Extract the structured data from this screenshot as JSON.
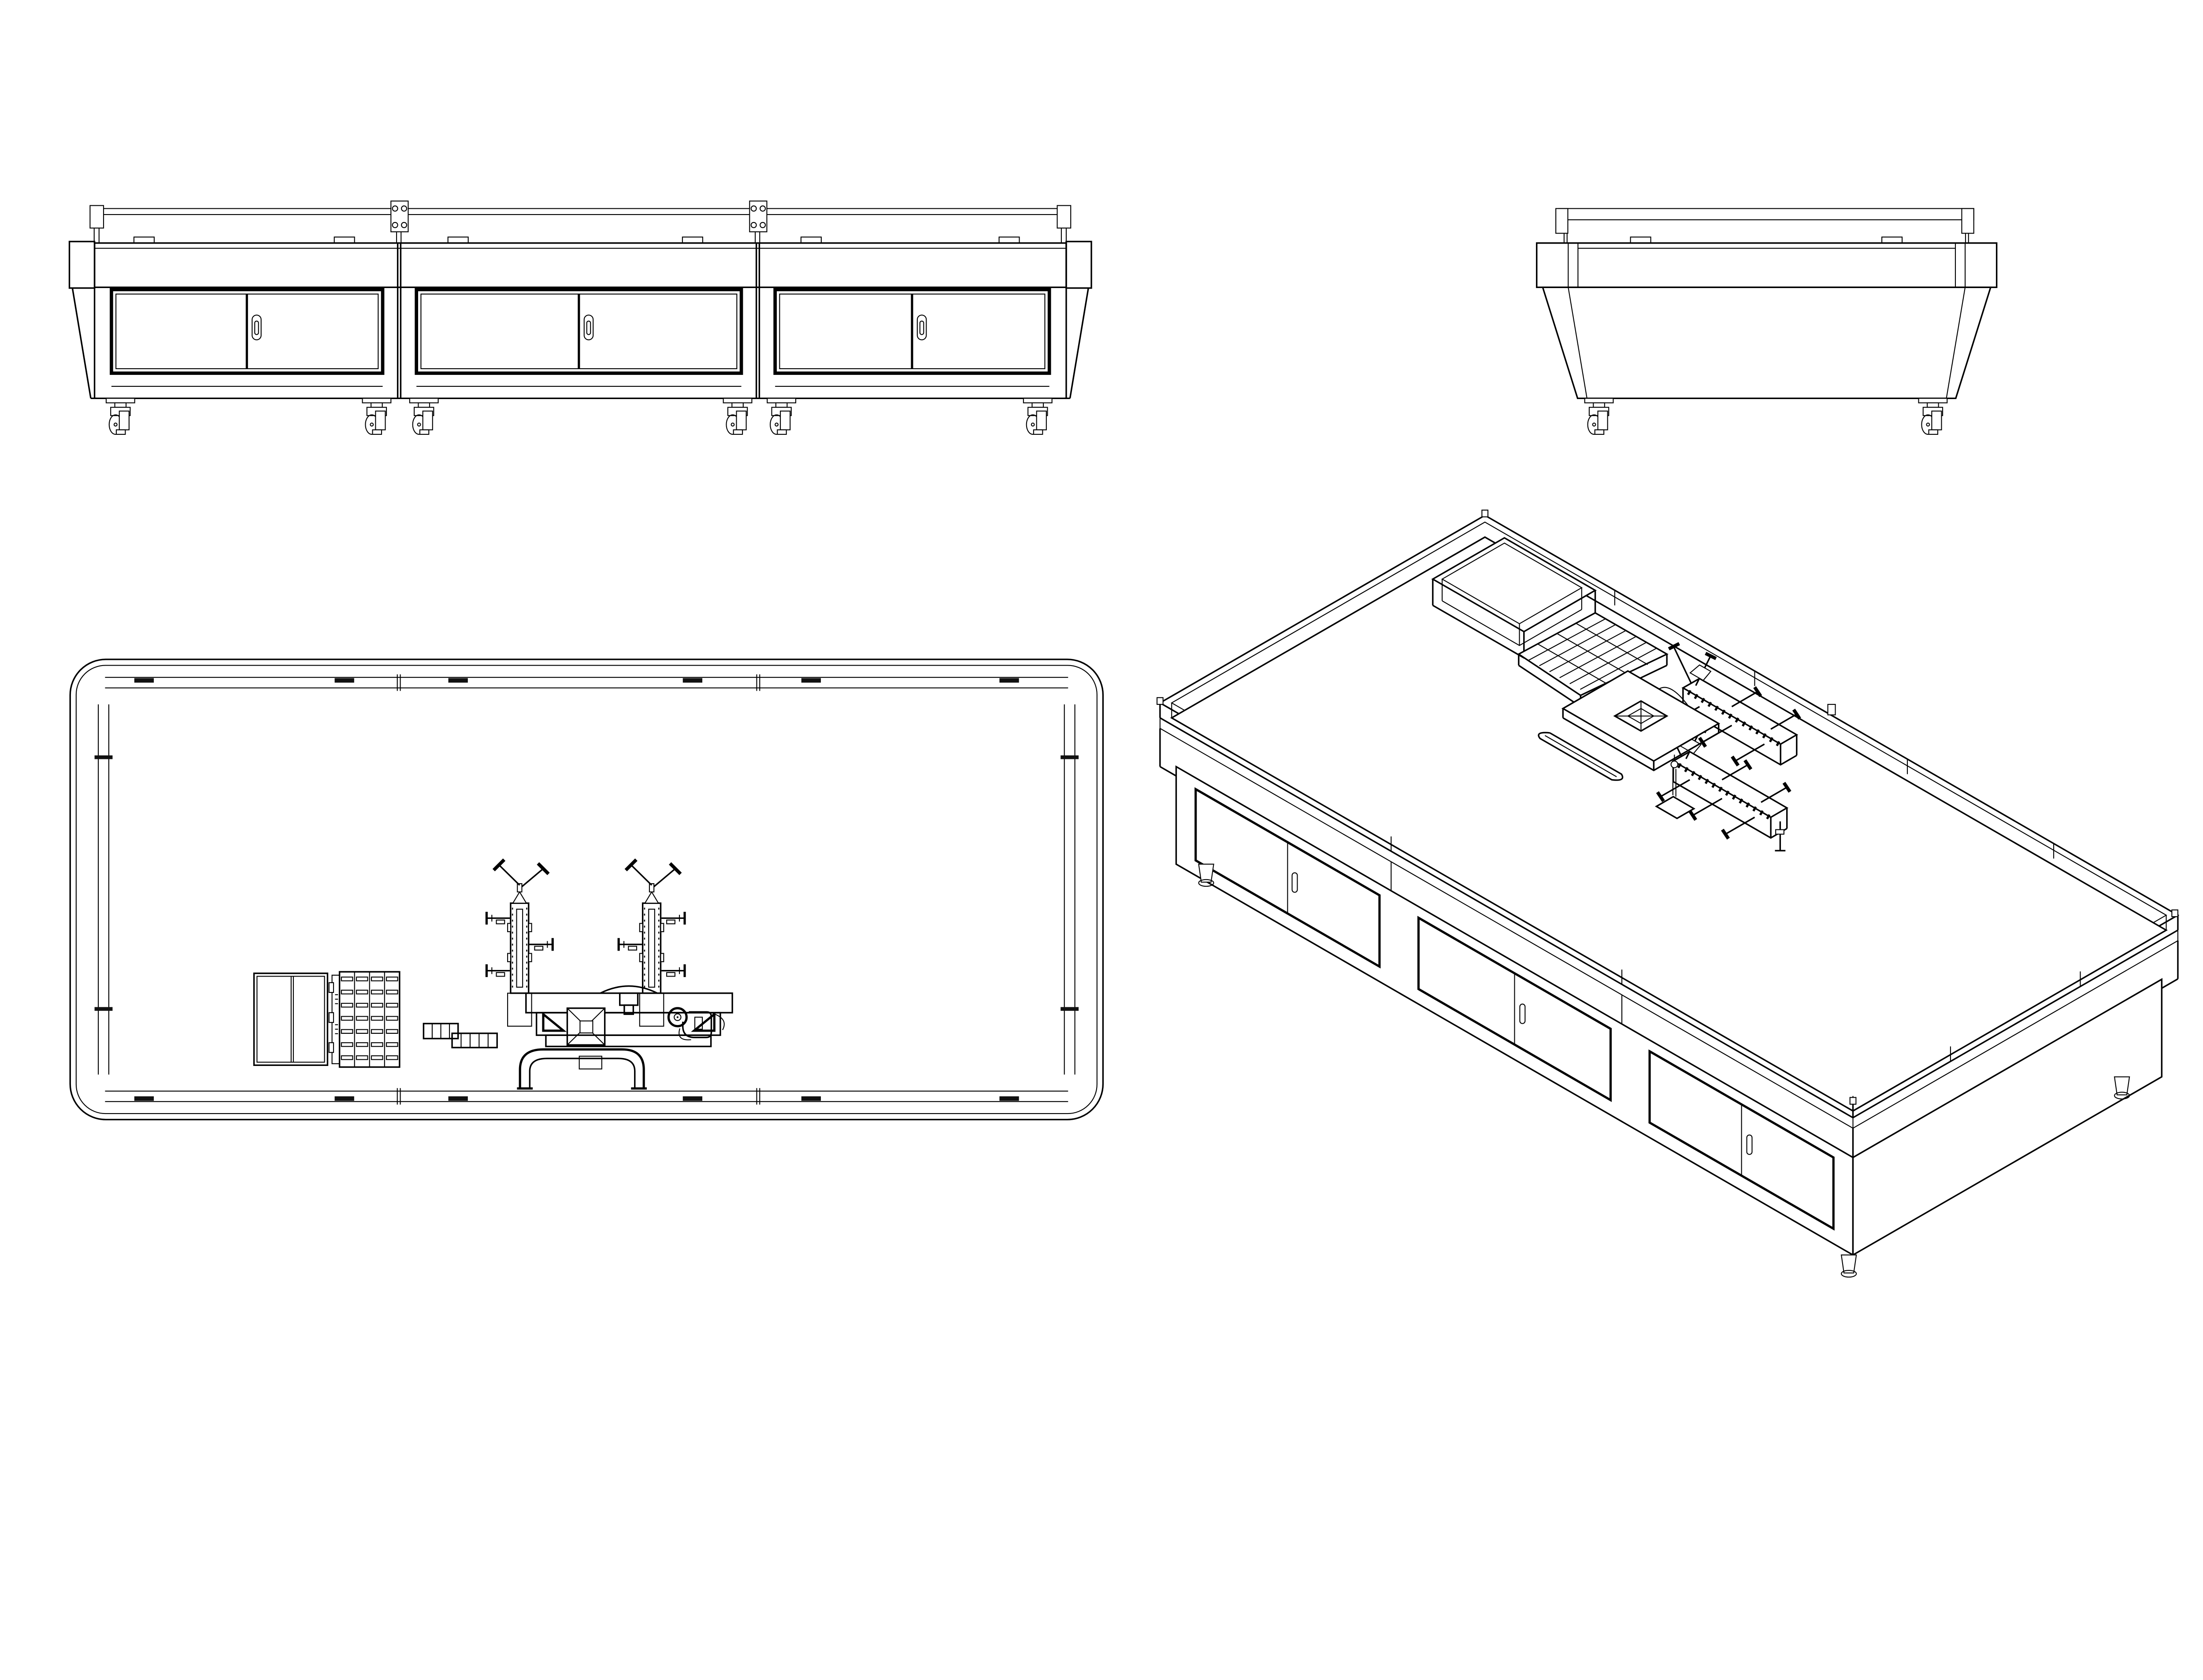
{
  "page": {
    "background": "#ffffff",
    "line_color": "#000000",
    "accent_fill": "#111111",
    "content": "monochrome multi-view CAD line drawing of a mobile cabinet workbench"
  },
  "drawing": {
    "kind": "technical orthographic and isometric views",
    "views": [
      {
        "id": "front-elevation",
        "label": "front elevation view",
        "position": "top-left",
        "cabinet_modules": 3,
        "sliding_doors_per_module": 2,
        "oval_door_handles": 3,
        "casters": 6,
        "top_rail_clips": 6,
        "glass_joint_plates": 2,
        "corner_posts": 2,
        "tapered_end_panels": 2
      },
      {
        "id": "end-elevation",
        "label": "end elevation view",
        "position": "top-right",
        "casters": 2,
        "top_rail_clips": 2,
        "lid_corner_tabs": 2,
        "tapered_body": true
      },
      {
        "id": "plan",
        "label": "top plan view",
        "position": "bottom-left",
        "rounded_corner_top": true,
        "perimeter_rail_clips": 12,
        "rail_joint_ticks": 4,
        "tabletop_items": [
          "dual-panel box",
          "bin grid tray",
          "step block",
          "left fixture rail with toggle clamps",
          "right fixture rail with toggle clamps",
          "center machine base with cross square",
          "u-shaped bracket",
          "knob with hook bracket"
        ]
      },
      {
        "id": "isometric",
        "label": "isometric view",
        "position": "bottom-right",
        "cabinet_modules_visible": 3,
        "feet_visible": 3,
        "tabletop_items": [
          "open box",
          "bin grid tray",
          "step block",
          "far fixture rail with clamps",
          "near fixture rail with clamps",
          "machine plate with cross square",
          "u-shaped bracket",
          "turret bracket"
        ]
      }
    ],
    "bin_grid": {
      "columns": 4,
      "rows": 7
    },
    "caster_type": "swivel wheel",
    "handle_type": "recessed oval"
  }
}
